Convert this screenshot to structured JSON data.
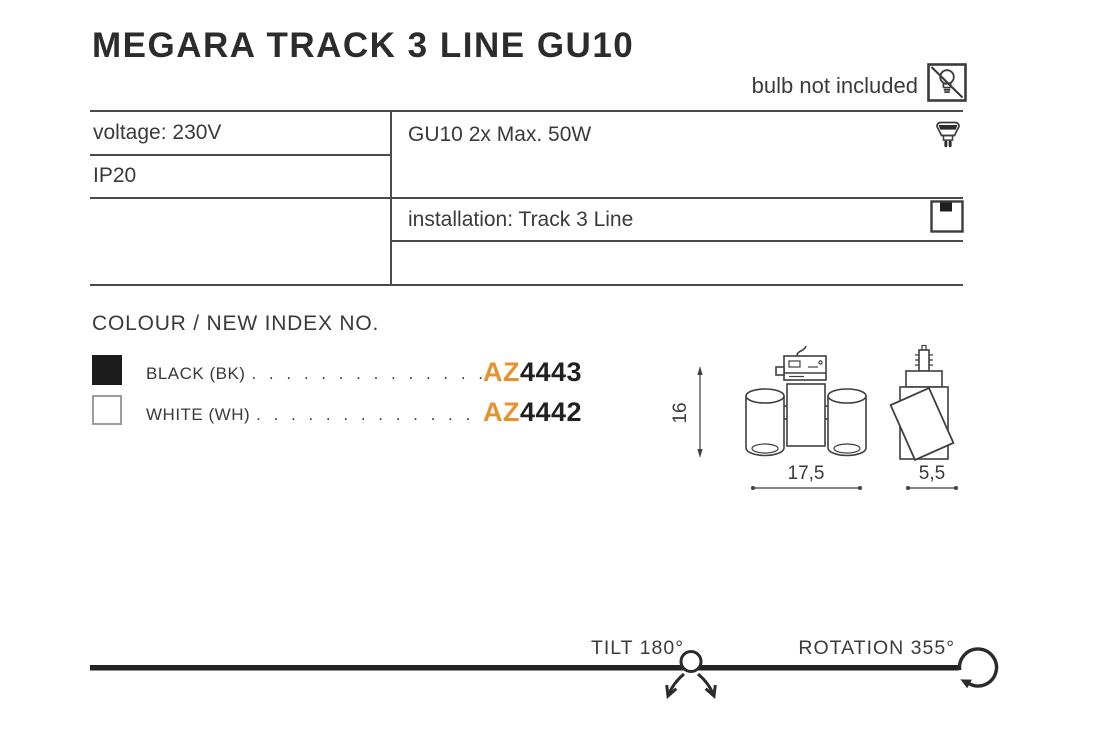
{
  "header": {
    "title": "MEGARA TRACK 3 LINE GU10",
    "bulb_note": "bulb not included"
  },
  "specs": {
    "voltage": "voltage: 230V",
    "ip_rating": "IP20",
    "lamp": "GU10 2x Max. 50W",
    "installation": "installation: Track 3 Line"
  },
  "colour_section": {
    "heading": "COLOUR / NEW INDEX NO.",
    "options": [
      {
        "name": "black",
        "swatch_color": "#1c1c1c",
        "label": "BLACK (BK)",
        "dots": ". . . . . . . . . . . . . .",
        "code_prefix": "AZ",
        "code_number": "4443"
      },
      {
        "name": "white",
        "swatch_color": "#ffffff",
        "label": "WHITE (WH)",
        "dots": ". . . . . . . . . . . . . .",
        "code_prefix": "AZ",
        "code_number": "4442"
      }
    ],
    "accent_color": "#e8922e"
  },
  "drawing": {
    "height_dim": "16",
    "width_dim": "17,5",
    "depth_dim": "5,5"
  },
  "motion": {
    "tilt_label": "TILT 180°",
    "rotation_label": "ROTATION 355°"
  },
  "icons": {
    "no_bulb": "bulb-crossed-out",
    "gu10": "gu10-bulb",
    "installation": "track-mount-square"
  },
  "colors": {
    "text": "#3a3a3c",
    "table_line": "#4b4b4d",
    "accent_orange": "#e8922e",
    "ink": "#231f20"
  }
}
